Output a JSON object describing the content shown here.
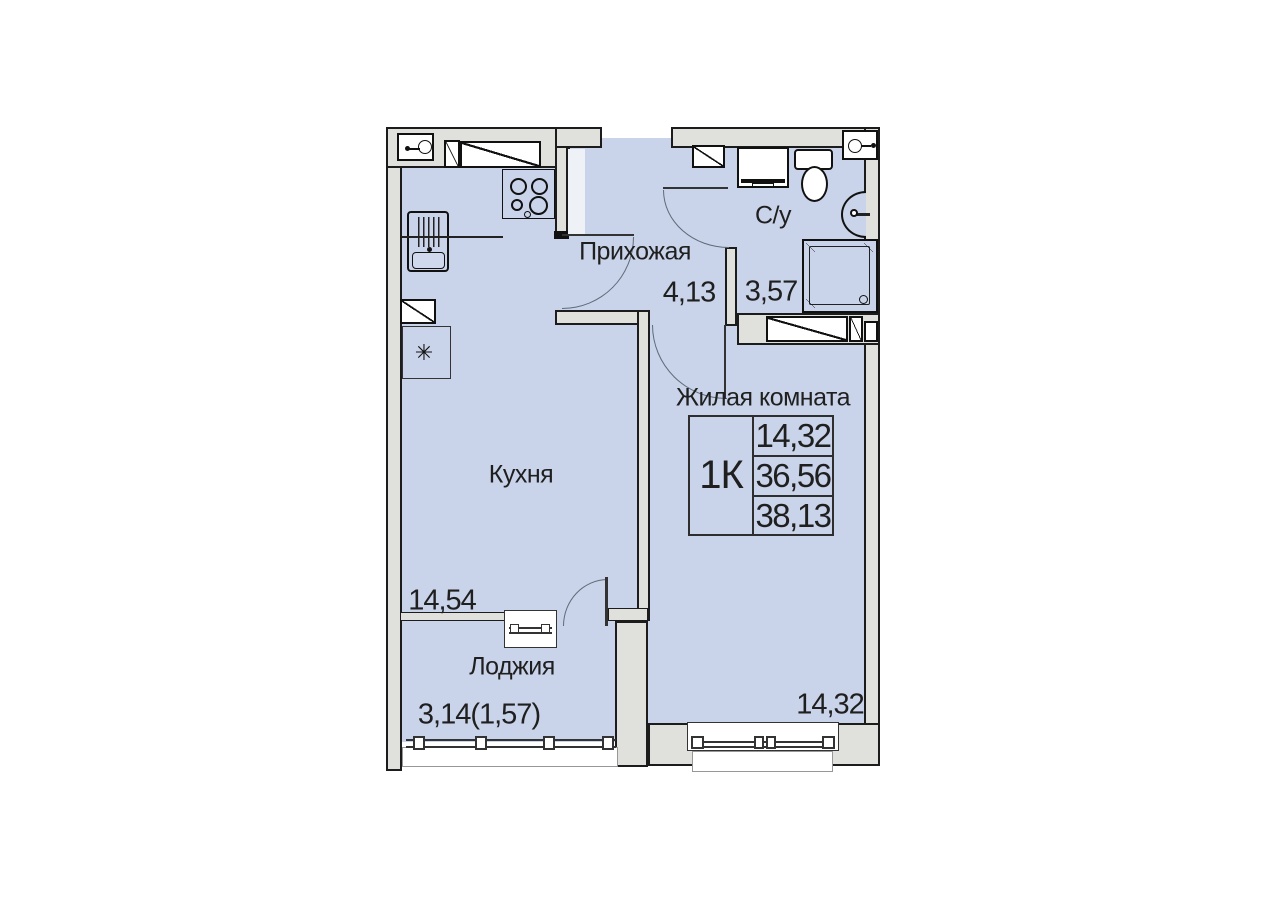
{
  "plan": {
    "apartment_type": "1К",
    "rooms": {
      "hallway": {
        "label": "Прихожая",
        "area": "4,13"
      },
      "bathroom": {
        "label": "С/у",
        "area": "3,57"
      },
      "kitchen": {
        "label": "Кухня",
        "area": "14,54"
      },
      "living": {
        "label": "Жилая комната",
        "area": "14,32"
      },
      "loggia": {
        "label": "Лоджия",
        "area": "3,14(1,57)"
      }
    },
    "info_table": {
      "type": "1К",
      "rows": [
        "14,32",
        "36,56",
        "38,13"
      ]
    },
    "symbols": {
      "fridge": "✳"
    },
    "colors": {
      "floor_fill": "#c9d3e9",
      "wall_fill": "#e0e0dd",
      "wall_line": "#1c1c1c",
      "text": "#1f1f1f"
    }
  }
}
